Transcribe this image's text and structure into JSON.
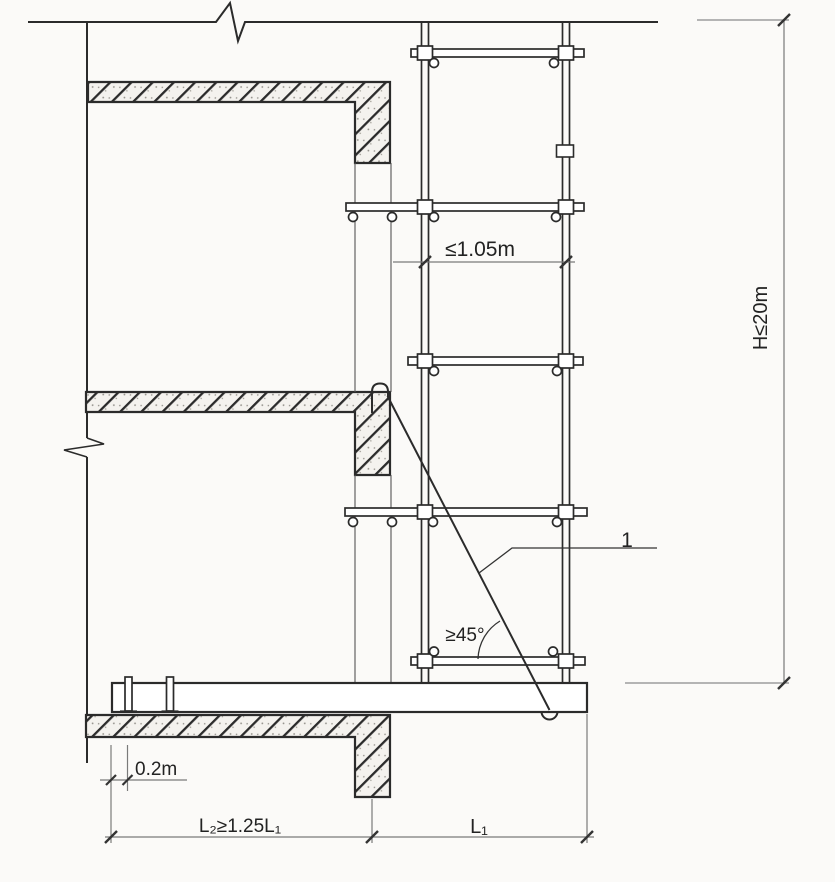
{
  "diagram": {
    "dimensions": {
      "pole_spacing": "≤1.05m",
      "total_height": "H≤20m",
      "anchor_edge_offset": "0.2m",
      "inner_beam_span": "L₂≥1.25L₁",
      "cantilever_span": "L₁"
    },
    "annotations": {
      "brace_angle": "≥45°",
      "callout_1": "1"
    },
    "colors": {
      "structure_line": "#2b2b2b",
      "dimension_line": "#7a7a7a",
      "tick_mark": "#333333",
      "concrete_fill": "#f4f2ee",
      "background": "#fbfaf8"
    }
  }
}
